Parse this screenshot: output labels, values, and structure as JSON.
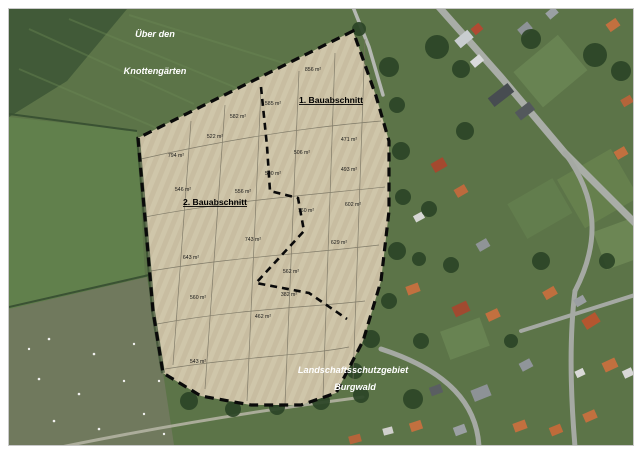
{
  "region_labels": {
    "top_line1": "Über den",
    "top_line2": "Knottengärten",
    "bottom_line1": "Landschaftsschutzgebiet",
    "bottom_line2": "Burgwald"
  },
  "phases": {
    "phase1": "1. Bauabschnitt",
    "phase2": "2. Bauabschnitt"
  },
  "parcels": [
    {
      "area": "856 m²"
    },
    {
      "area": "585 m²"
    },
    {
      "area": "582 m²"
    },
    {
      "area": "522 m²"
    },
    {
      "area": "471 m²"
    },
    {
      "area": "794 m²"
    },
    {
      "area": "506 m²"
    },
    {
      "area": "493 m²"
    },
    {
      "area": "546 m²"
    },
    {
      "area": "556 m²"
    },
    {
      "area": "500 m²"
    },
    {
      "area": "760 m²"
    },
    {
      "area": "602 m²"
    },
    {
      "area": "743 m²"
    },
    {
      "area": "629 m²"
    },
    {
      "area": "643 m²"
    },
    {
      "area": "562 m²"
    },
    {
      "area": "560 m²"
    },
    {
      "area": "382 m²"
    },
    {
      "area": "462 m²"
    },
    {
      "area": "543 m²"
    }
  ],
  "colors": {
    "site_fill": "#cbc2a6",
    "site_stripe": "#c2b89b",
    "boundary_dash": "#0a0a0a",
    "field_green": "#5c7448",
    "field_bright": "#61804c",
    "field_olive": "#70795d",
    "forest_dark": "#2c4527",
    "road_gray": "#a9ada7",
    "roof_red": "#a14a30",
    "roof_orange": "#c2703f",
    "roof_gray": "#8d9296",
    "label_white": "#ffffff"
  }
}
